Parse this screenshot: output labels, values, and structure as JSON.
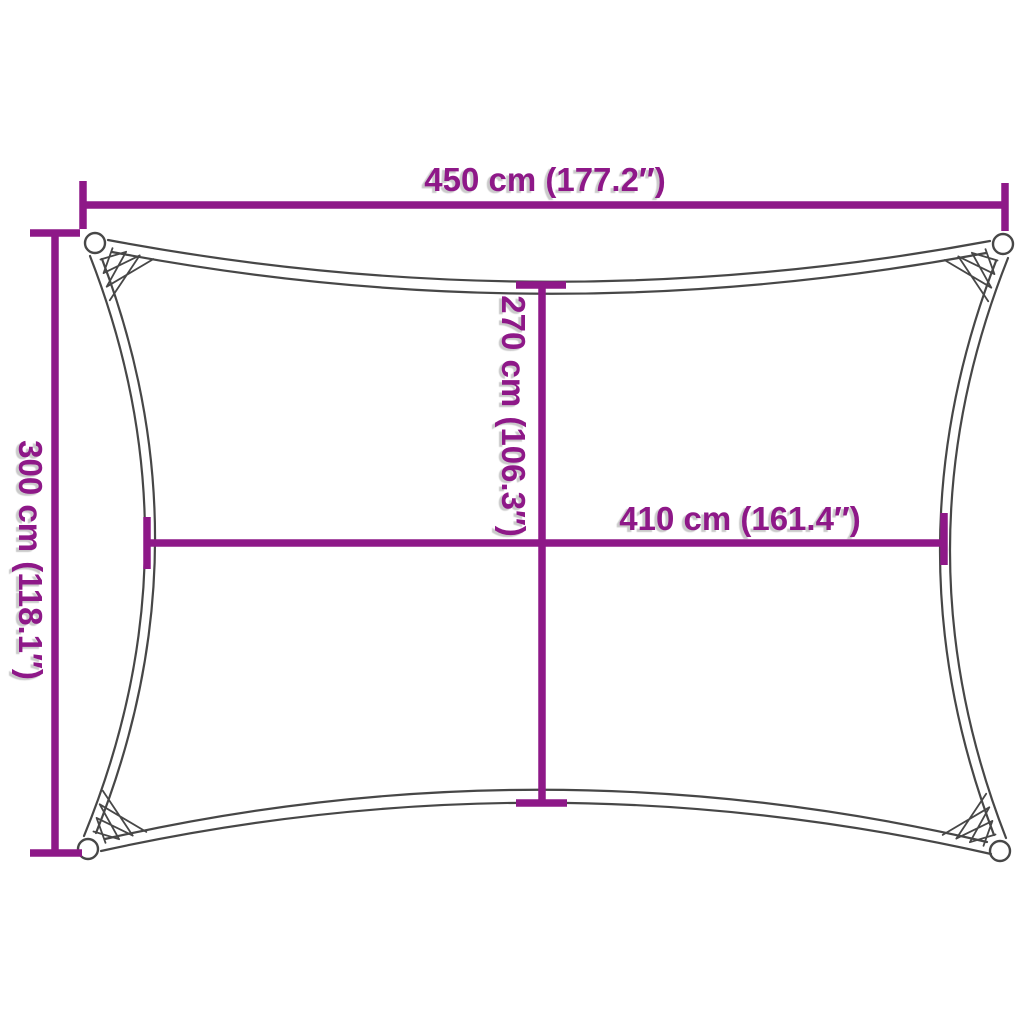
{
  "diagram": {
    "kind": "shade-sail-dimension-diagram",
    "dimensions": {
      "top_width": "450 cm (177.2″)",
      "left_height": "300 cm (118.1″)",
      "center_height": "270 cm (106.3″)",
      "center_width": "410 cm (161.4″)"
    },
    "colors": {
      "dimension_accent": "#8E1888",
      "sail_outline": "#474747",
      "background": "#FFFFFF"
    }
  }
}
